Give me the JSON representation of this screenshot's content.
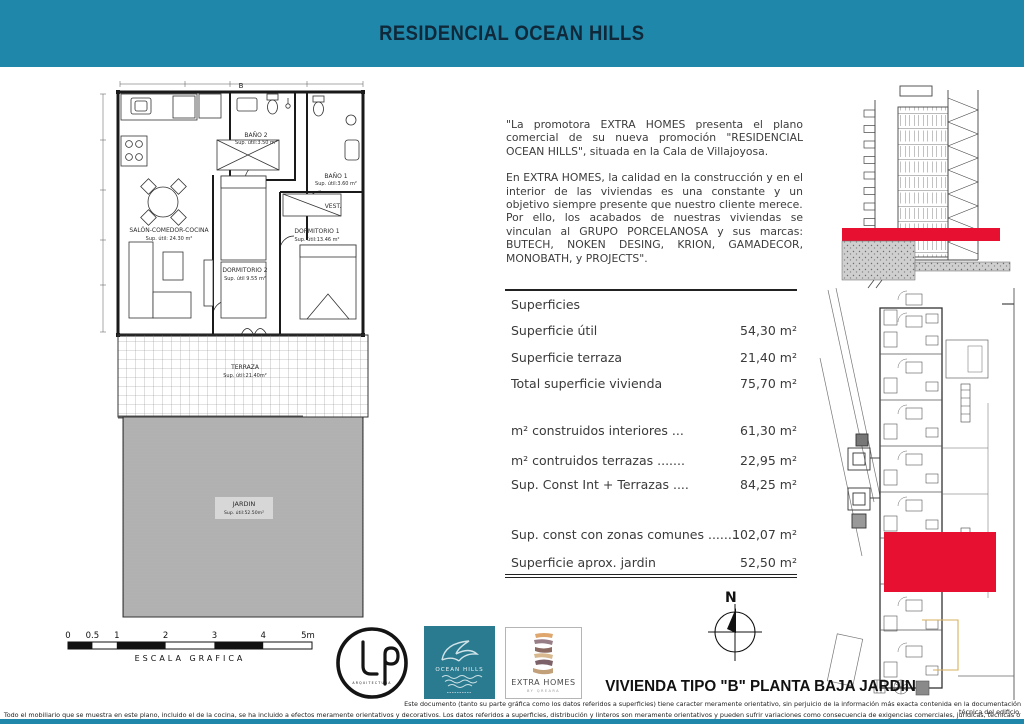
{
  "header": {
    "title": "RESIDENCIAL OCEAN HILLS"
  },
  "colors": {
    "header_bg": "#1f87aa",
    "highlight_red": "#e81030",
    "ocean_logo_teal": "#2b7b90"
  },
  "intro": {
    "p1": "\"La promotora EXTRA HOMES  presenta el plano comercial de su nueva promoción \"RESIDENCIAL OCEAN HILLS\", situada en la Cala de Villajoyosa.",
    "p2": "En EXTRA HOMES, la calidad en la construcción y en el interior de las viviendas es una constante y un objetivo siempre presente que nuestro cliente merece.",
    "p3": "Por ello, los acabados de nuestras viviendas se vinculan al GRUPO PORCELANOSA y sus marcas: BUTECH, NOKEN DESING, KRION, GAMADECOR, MONOBATH, y PROJECTS\"."
  },
  "surfaces": {
    "heading": "Superficies",
    "rows": [
      {
        "label": "Superficie útil",
        "value": "54,30 m²"
      },
      {
        "label": "Superficie terraza",
        "value": "21,40 m²"
      },
      {
        "label": "Total superficie vivienda",
        "value": "75,70 m²"
      },
      {
        "label": "m² construidos interiores ...",
        "value": "61,30 m²"
      },
      {
        "label": "m² contruidos terrazas .......",
        "value": "22,95 m²"
      },
      {
        "label": "Sup. Const Int + Terrazas ....",
        "value": "84,25 m²"
      },
      {
        "label": "Sup. const con zonas comunes ........",
        "value": "102,07 m²"
      },
      {
        "label": "Superficie aprox. jardin",
        "value": "52,50 m²"
      }
    ]
  },
  "floor_plan": {
    "block_label": "B",
    "salon": {
      "name": "SALÓN-COMEDOR-COCINA",
      "area": "Sup. útil: 24.30 m²"
    },
    "bano2": {
      "name": "BAÑO 2",
      "area": "Sup. útil:3.50 m²"
    },
    "bano1": {
      "name": "BAÑO 1",
      "area": "Sup. útil:3.60 m²"
    },
    "vest": {
      "name": "VEST."
    },
    "dorm1": {
      "name": "DORMITORIO 1",
      "area": "Sup. útil:13.46 m²"
    },
    "dorm2": {
      "name": "DORMITORIO 2",
      "area": "Sup. útil 9.55 m²"
    },
    "terraza": {
      "name": "TERRAZA",
      "area": "Sup. útil:21.40m²"
    },
    "jardin": {
      "name": "JARDIN",
      "area": "Sup. útil:52.50m²"
    }
  },
  "scale_bar": {
    "ticks": [
      "0",
      "0.5",
      "1",
      "2",
      "3",
      "4",
      "5m"
    ],
    "label": "ESCALA GRAFICA"
  },
  "logos": {
    "lp": {
      "subtext": "ARQUITECTURA"
    },
    "ocean_hills": {
      "name": "OCEAN HILLS"
    },
    "extra_homes": {
      "name": "EXTRA HOMES",
      "subtext": "BY QREARA"
    }
  },
  "compass": {
    "north_label": "N"
  },
  "plan_title": "VIVIENDA TIPO \"B\" PLANTA BAJA JARDIN",
  "disclaimers": {
    "line1": "Este documento (tanto su parte gráfica como los datos referidos a superficies) tiene caracter meramente orientativo, sin perjuicio de la información más exacta contenida en la documentación técnica del edificio.",
    "line2": "Todo el mobiliario que se muestra en este plano, incluido el de la cocina, se ha incluido a efectos meramente orientativos y decorativos. Los datos referidos a superficies, distribución y linteros son meramente orientativos y pueden sufrir variaciones como consecuencia de exigencias comerciales, jurídicas, técnicas o de ejecución de proyecto."
  }
}
